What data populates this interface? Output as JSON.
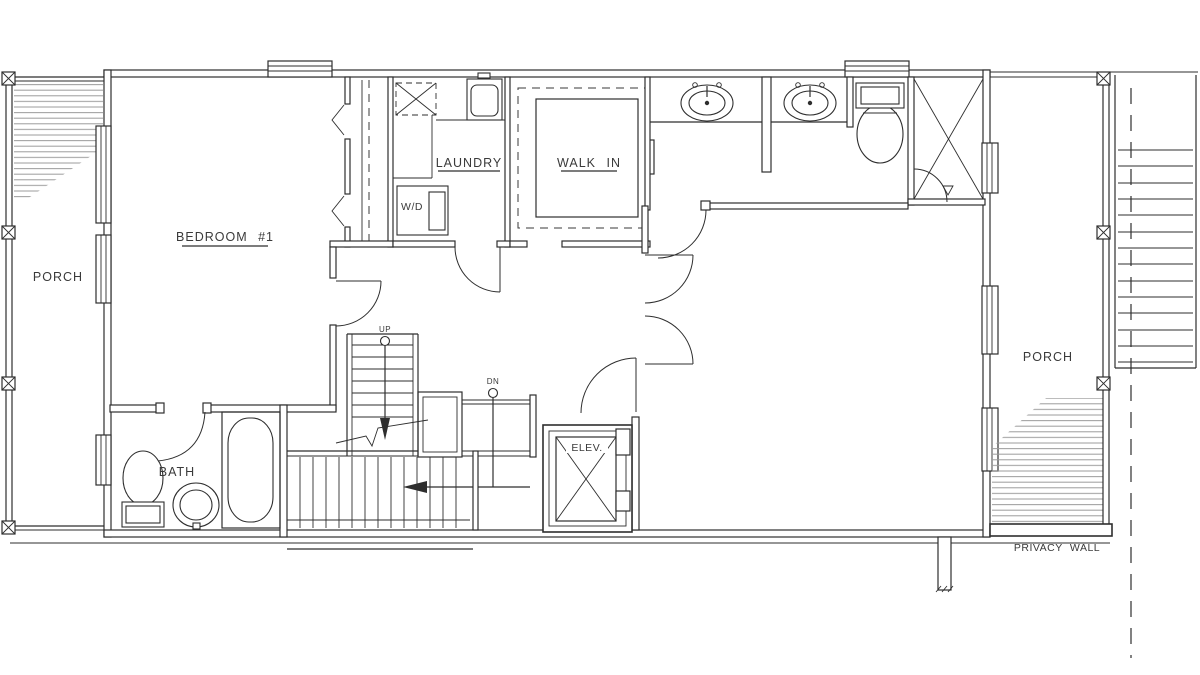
{
  "drawing": {
    "type": "architectural-floor-plan",
    "labels": {
      "porch_left": "PORCH",
      "bedroom1": "BEDROOM  #1",
      "laundry": "LAUNDRY",
      "walk_in": "WALK  IN",
      "wd": "W/D",
      "up": "UP",
      "dn": "DN",
      "elev": "ELEV.",
      "bath": "BATH",
      "porch_right": "PORCH",
      "privacy_wall": "PRIVACY  WALL"
    },
    "colors": {
      "background": "#ffffff",
      "wall_line": "#2e2e2e",
      "hatch_line": "#9b9b9b",
      "text": "#3a3a3a"
    }
  }
}
